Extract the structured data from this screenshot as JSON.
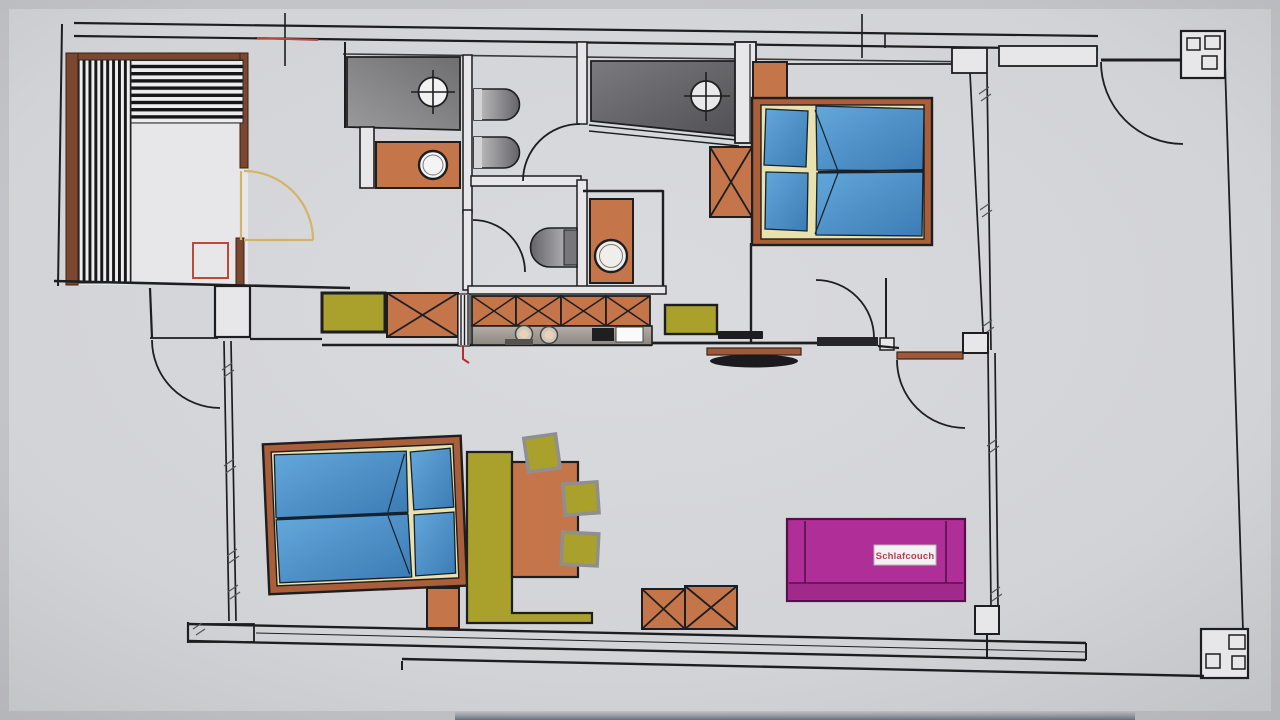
{
  "labels": {
    "sleeper_couch": "Schlafcouch"
  },
  "icons": {
    "floor_drain": "circle-with-cross drain symbol",
    "crossed_box": "X-crossed square cabinet symbol",
    "door_swing": "quarter-circle door swing arc",
    "column": "structural column symbol",
    "deck_stripes": "striped decking hatch"
  },
  "colors": {
    "paper": "#d2d3d6",
    "wall": "#1e1e20",
    "wallfill": "#e7e7e9",
    "frame": "#7c4730",
    "stripe": "#161616",
    "stripelight": "#ededef",
    "orange": "#c4764a",
    "olive": "#aaa02c",
    "blue1": "#63a7da",
    "blue2": "#3c7cb5",
    "cream": "#e9e2ae",
    "bedframe": "#a95f3a",
    "shower1a": "#9a9a9c",
    "shower1b": "#6e6e70",
    "shower2a": "#7b7b7e",
    "shower2b": "#515154",
    "toileta": "#c6c6c8",
    "toiletb": "#646468",
    "countera": "#b5aea8",
    "counterb": "#8d8780",
    "magenta": "#b02e98",
    "magentadark": "#551049",
    "magentaseat": "#a02a8a",
    "yellow": "#d3b469",
    "red": "#bf4936",
    "labelred": "#b24052",
    "chairgray": "#8f8f91",
    "smudge": "#79858f",
    "brownbar": "#9c5a3c"
  }
}
